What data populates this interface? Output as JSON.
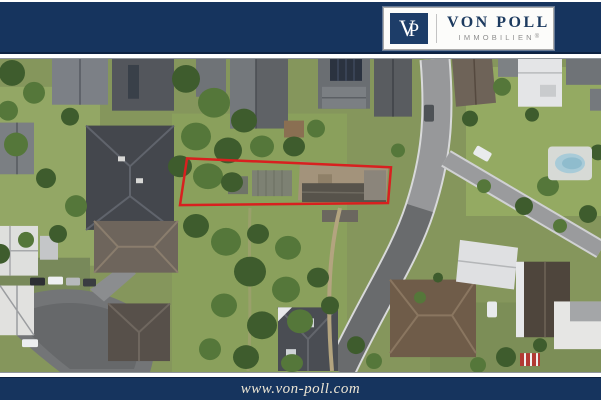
{
  "theme": {
    "navy": "#16345e",
    "logo-navy": "#1d3d68",
    "text-navy": "#1c3a5f",
    "subtitle-gray": "#8e8e8e",
    "outline-red": "#d8201f",
    "footer-text": "#ece5d4"
  },
  "header": {
    "logo": {
      "monogram_v": "V",
      "monogram_p": "P",
      "name": "VON POLL",
      "subtitle": "IMMOBILIEN",
      "registered": "®"
    }
  },
  "photo": {
    "description": "Aerial drone view of a residential neighborhood; elongated property plot outlined in red between gardens and a curving street"
  },
  "footer": {
    "website": "www.von-poll.com"
  }
}
